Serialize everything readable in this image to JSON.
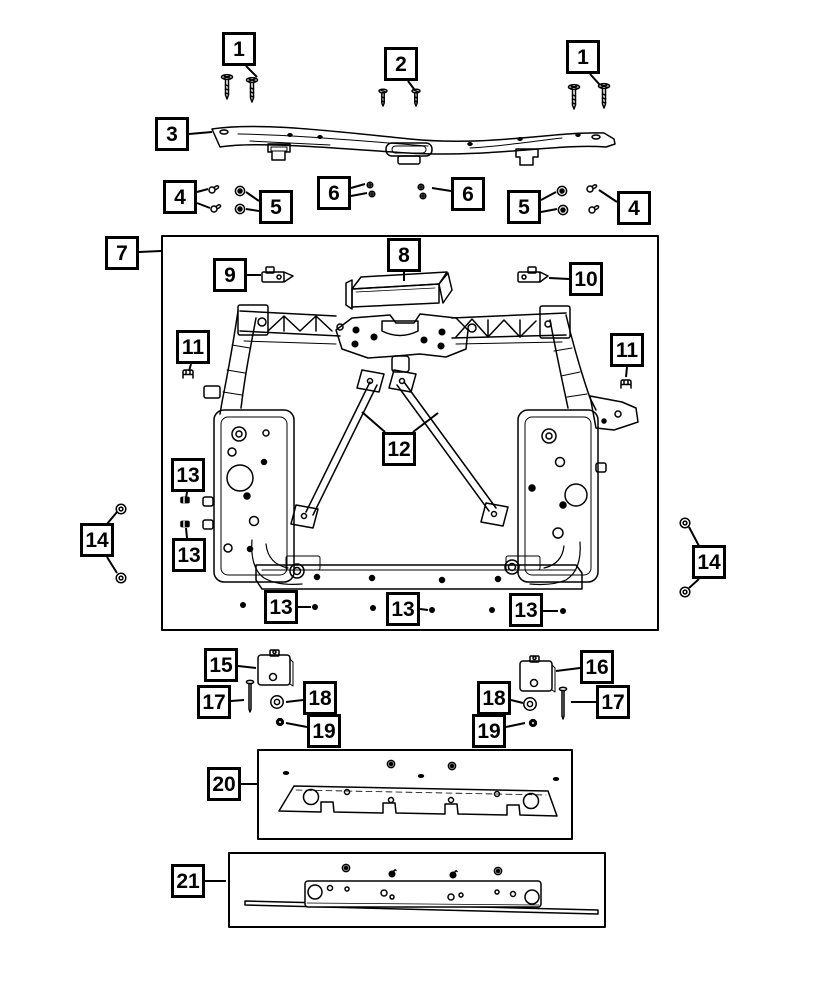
{
  "diagram": {
    "paper_color": "#ffffff",
    "ink_color": "#000000",
    "callout_style": {
      "size": 34,
      "border_px": 3,
      "font_size": 21
    },
    "callouts": [
      {
        "label": "1",
        "x": 239,
        "y": 49,
        "leaders": [
          [
            [
              246,
              66
            ],
            [
              257,
              77
            ]
          ]
        ]
      },
      {
        "label": "2",
        "x": 401,
        "y": 64,
        "leaders": [
          [
            [
              408,
              81
            ],
            [
              414,
              89
            ]
          ]
        ]
      },
      {
        "label": "1",
        "x": 583,
        "y": 57,
        "leaders": [
          [
            [
              590,
              74
            ],
            [
              600,
              85
            ]
          ]
        ]
      },
      {
        "label": "3",
        "x": 172,
        "y": 134,
        "leaders": [
          [
            [
              189,
              134
            ],
            [
              212,
              132
            ]
          ]
        ]
      },
      {
        "label": "4",
        "x": 180,
        "y": 197,
        "leaders": [
          [
            [
              197,
              192
            ],
            [
              208,
              189
            ]
          ],
          [
            [
              197,
              203
            ],
            [
              210,
              208
            ]
          ]
        ]
      },
      {
        "label": "5",
        "x": 276,
        "y": 207,
        "leaders": [
          [
            [
              259,
              201
            ],
            [
              246,
              192
            ]
          ],
          [
            [
              259,
              211
            ],
            [
              246,
              209
            ]
          ]
        ]
      },
      {
        "label": "6",
        "x": 334,
        "y": 193,
        "leaders": [
          [
            [
              351,
              188
            ],
            [
              365,
              184
            ]
          ],
          [
            [
              351,
              196
            ],
            [
              367,
              193
            ]
          ]
        ]
      },
      {
        "label": "6",
        "x": 468,
        "y": 194,
        "leaders": [
          [
            [
              451,
              191
            ],
            [
              432,
              188
            ]
          ]
        ]
      },
      {
        "label": "5",
        "x": 524,
        "y": 207,
        "leaders": [
          [
            [
              541,
              200
            ],
            [
              556,
              192
            ]
          ],
          [
            [
              541,
              212
            ],
            [
              557,
              209
            ]
          ]
        ]
      },
      {
        "label": "4",
        "x": 634,
        "y": 208,
        "leaders": [
          [
            [
              617,
              202
            ],
            [
              599,
              190
            ]
          ]
        ]
      },
      {
        "label": "7",
        "x": 122,
        "y": 253,
        "leaders": [
          [
            [
              139,
              252
            ],
            [
              161,
              251
            ]
          ]
        ]
      },
      {
        "label": "9",
        "x": 230,
        "y": 275,
        "leaders": [
          [
            [
              247,
              275
            ],
            [
              261,
              275
            ]
          ]
        ]
      },
      {
        "label": "8",
        "x": 404,
        "y": 255,
        "leaders": [
          [
            [
              404,
              272
            ],
            [
              404,
              281
            ]
          ]
        ]
      },
      {
        "label": "10",
        "x": 586,
        "y": 279,
        "leaders": [
          [
            [
              569,
              279
            ],
            [
              549,
              278
            ]
          ]
        ]
      },
      {
        "label": "11",
        "x": 193,
        "y": 347,
        "leaders": [
          [
            [
              191,
              364
            ],
            [
              189,
              371
            ]
          ]
        ]
      },
      {
        "label": "11",
        "x": 627,
        "y": 350,
        "leaders": [
          [
            [
              627,
              367
            ],
            [
              626,
              377
            ]
          ]
        ]
      },
      {
        "label": "12",
        "x": 399,
        "y": 449,
        "leaders": [
          [
            [
              385,
              432
            ],
            [
              362,
              412
            ]
          ],
          [
            [
              413,
              432
            ],
            [
              438,
              413
            ]
          ]
        ]
      },
      {
        "label": "13",
        "x": 188,
        "y": 475,
        "leaders": [
          [
            [
              187,
              492
            ],
            [
              186,
              498
            ]
          ]
        ]
      },
      {
        "label": "13",
        "x": 189,
        "y": 555,
        "leaders": [
          [
            [
              187,
              538
            ],
            [
              186,
              528
            ]
          ]
        ]
      },
      {
        "label": "13",
        "x": 281,
        "y": 607,
        "leaders": [
          [
            [
              298,
              607
            ],
            [
              311,
              607
            ]
          ]
        ]
      },
      {
        "label": "13",
        "x": 403,
        "y": 609,
        "leaders": [
          [
            [
              420,
              609
            ],
            [
              428,
              610
            ]
          ]
        ]
      },
      {
        "label": "13",
        "x": 526,
        "y": 610,
        "leaders": [
          [
            [
              543,
              611
            ],
            [
              558,
              611
            ]
          ]
        ]
      },
      {
        "label": "14",
        "x": 97,
        "y": 540,
        "leaders": [
          [
            [
              107,
              524
            ],
            [
              117,
              512
            ]
          ],
          [
            [
              107,
              557
            ],
            [
              117,
              573
            ]
          ]
        ]
      },
      {
        "label": "14",
        "x": 709,
        "y": 562,
        "leaders": [
          [
            [
              699,
              546
            ],
            [
              689,
              527
            ]
          ],
          [
            [
              699,
              579
            ],
            [
              689,
              588
            ]
          ]
        ]
      },
      {
        "label": "15",
        "x": 221,
        "y": 665,
        "leaders": [
          [
            [
              238,
              666
            ],
            [
              256,
              668
            ]
          ]
        ]
      },
      {
        "label": "16",
        "x": 597,
        "y": 667,
        "leaders": [
          [
            [
              580,
              668
            ],
            [
              556,
              671
            ]
          ]
        ]
      },
      {
        "label": "17",
        "x": 214,
        "y": 702,
        "leaders": [
          [
            [
              231,
              701
            ],
            [
              244,
              700
            ]
          ]
        ]
      },
      {
        "label": "17",
        "x": 613,
        "y": 702,
        "leaders": [
          [
            [
              596,
              702
            ],
            [
              571,
              702
            ]
          ]
        ]
      },
      {
        "label": "18",
        "x": 320,
        "y": 698,
        "leaders": [
          [
            [
              303,
              700
            ],
            [
              286,
              702
            ]
          ]
        ]
      },
      {
        "label": "18",
        "x": 494,
        "y": 698,
        "leaders": [
          [
            [
              511,
              700
            ],
            [
              523,
              703
            ]
          ]
        ]
      },
      {
        "label": "19",
        "x": 324,
        "y": 731,
        "leaders": [
          [
            [
              307,
              727
            ],
            [
              286,
              723
            ]
          ]
        ]
      },
      {
        "label": "19",
        "x": 489,
        "y": 731,
        "leaders": [
          [
            [
              506,
              727
            ],
            [
              525,
              723
            ]
          ]
        ]
      },
      {
        "label": "20",
        "x": 224,
        "y": 784,
        "leaders": [
          [
            [
              241,
              784
            ],
            [
              257,
              784
            ]
          ]
        ]
      },
      {
        "label": "21",
        "x": 188,
        "y": 881,
        "leaders": [
          [
            [
              205,
              881
            ],
            [
              226,
              881
            ]
          ]
        ]
      }
    ]
  }
}
